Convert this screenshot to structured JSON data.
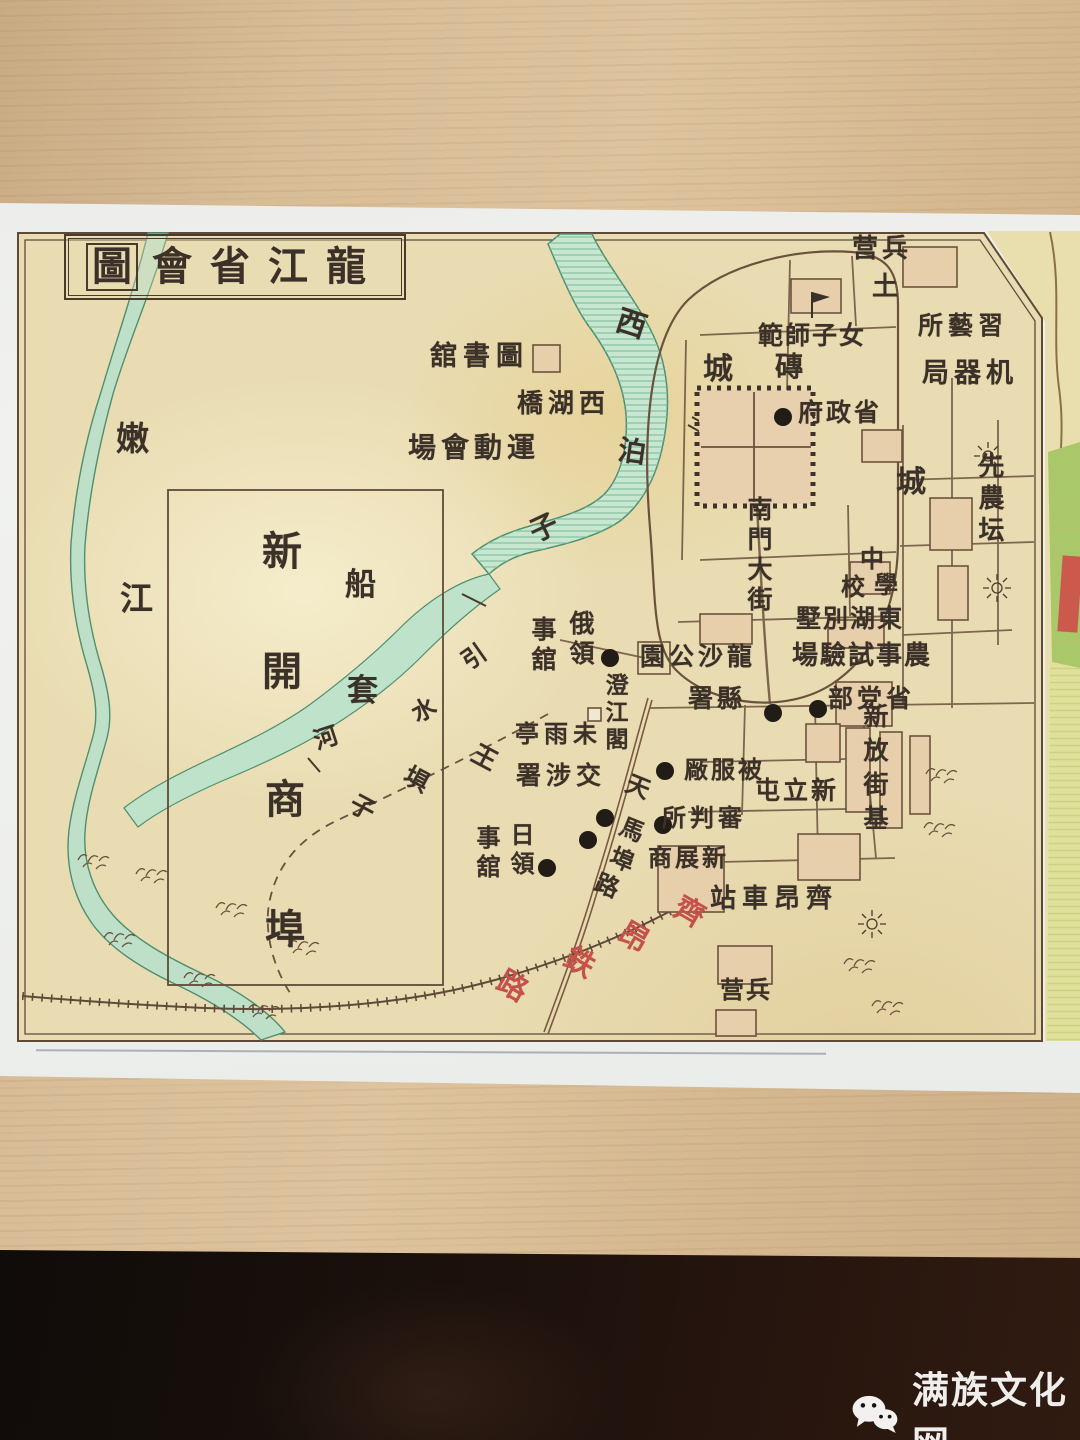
{
  "photo": {
    "scene": "old printed city map lying on a light wood table, dark foreground below table edge",
    "wood_color": "#d8bd97",
    "paper_color": "#eef0ee",
    "shadow_color": "#1a110c"
  },
  "watermark": {
    "text": "满族文化网",
    "icon": "wechat-icon",
    "color": "#efeeec"
  },
  "map": {
    "title": {
      "boxed_char": "圖",
      "rest_chars": "會省江龍",
      "reading_rtl": "龍江省會圖"
    },
    "colors": {
      "map_bg": "#e9dcb2",
      "line": "#5f4a38",
      "water_fill": "#c5e3cd",
      "water_edge": "#4f8f6f",
      "red_text": "#c4524a",
      "building_fill": "#e8cfab",
      "adjacent_strip_yellow": "#e9dfae",
      "adjacent_strip_green": "#a8c86a",
      "adjacent_red_patch": "#cc5a4c"
    },
    "labels": [
      {
        "t": "舘書圖",
        "reading": "圖書舘",
        "x": 430,
        "y": 343,
        "s": 27,
        "ls": 6
      },
      {
        "t": "橋湖西",
        "reading": "西湖橋",
        "x": 517,
        "y": 391,
        "s": 26,
        "ls": 5
      },
      {
        "t": "場會動運",
        "reading": "運動會場",
        "x": 408,
        "y": 434,
        "s": 28,
        "ls": 5
      },
      {
        "t": "嫩",
        "x": 116,
        "y": 422,
        "s": 33
      },
      {
        "t": "江",
        "x": 120,
        "y": 582,
        "s": 33
      },
      {
        "t": "西",
        "x": 616,
        "y": 310,
        "s": 30,
        "rot": 18
      },
      {
        "t": "泊",
        "x": 618,
        "y": 438,
        "s": 28,
        "rot": 8
      },
      {
        "t": "子",
        "x": 530,
        "y": 514,
        "s": 28,
        "rot": -25
      },
      {
        "t": "引",
        "x": 462,
        "y": 645,
        "s": 24,
        "rot": -35
      },
      {
        "t": "水",
        "x": 412,
        "y": 698,
        "s": 24,
        "rot": -28
      },
      {
        "t": "河",
        "x": 314,
        "y": 726,
        "s": 24,
        "rot": -18
      },
      {
        "t": "磚",
        "x": 775,
        "y": 353,
        "s": 28
      },
      {
        "t": "城",
        "x": 703,
        "y": 355,
        "s": 30
      },
      {
        "t": "土",
        "x": 872,
        "y": 274,
        "s": 26
      },
      {
        "t": "城",
        "x": 896,
        "y": 468,
        "s": 30
      },
      {
        "t": "营兵",
        "reading": "兵营",
        "x": 852,
        "y": 236,
        "s": 26,
        "ls": 4
      },
      {
        "t": "範師子女",
        "reading": "女子師範",
        "x": 758,
        "y": 323,
        "s": 25,
        "ls": 2
      },
      {
        "t": "所藝習",
        "reading": "習藝所",
        "x": 918,
        "y": 313,
        "s": 25,
        "ls": 5
      },
      {
        "t": "局器机",
        "reading": "机器局",
        "x": 922,
        "y": 360,
        "s": 27,
        "ls": 5
      },
      {
        "t": "府政省",
        "reading": "省政府",
        "x": 798,
        "y": 400,
        "s": 25,
        "ls": 3
      },
      {
        "t": "先農坛",
        "x": 976,
        "y": 452,
        "s": 26,
        "dir": "v",
        "ls": 6
      },
      {
        "t": "南門大街",
        "x": 746,
        "y": 496,
        "s": 25,
        "dir": "v",
        "ls": 5
      },
      {
        "t": "中",
        "x": 860,
        "y": 547,
        "s": 24
      },
      {
        "t": "學",
        "x": 874,
        "y": 573,
        "s": 24
      },
      {
        "t": "校",
        "x": 841,
        "y": 575,
        "s": 24
      },
      {
        "t": "墅別湖東",
        "reading": "東湖別墅",
        "x": 796,
        "y": 606,
        "s": 25,
        "ls": 2
      },
      {
        "t": "場驗試事農",
        "reading": "農事試驗場",
        "x": 792,
        "y": 643,
        "s": 26,
        "ls": 2
      },
      {
        "t": "部党省",
        "reading": "省党部",
        "x": 828,
        "y": 686,
        "s": 25,
        "ls": 4
      },
      {
        "t": "園公沙龍",
        "reading": "龍沙公園",
        "x": 640,
        "y": 644,
        "s": 25,
        "ls": 4
      },
      {
        "t": "署縣",
        "reading": "縣署",
        "x": 688,
        "y": 686,
        "s": 25,
        "ls": 4
      },
      {
        "t": "澄江閣",
        "x": 602,
        "y": 673,
        "s": 23,
        "dir": "v",
        "ls": 4
      },
      {
        "t": "亭雨未",
        "reading": "未雨亭",
        "x": 515,
        "y": 722,
        "s": 24,
        "ls": 5
      },
      {
        "t": "俄領",
        "x": 568,
        "y": 610,
        "s": 25,
        "dir": "v",
        "ls": 5
      },
      {
        "t": "事舘",
        "x": 530,
        "y": 616,
        "s": 25,
        "dir": "v",
        "ls": 5
      },
      {
        "t": "署涉交",
        "reading": "交涉署",
        "x": 516,
        "y": 763,
        "s": 25,
        "ls": 5
      },
      {
        "t": "厰服被",
        "reading": "被服厰",
        "x": 684,
        "y": 758,
        "s": 24,
        "ls": 3
      },
      {
        "t": "所判審",
        "reading": "審判所",
        "x": 662,
        "y": 806,
        "s": 24,
        "ls": 4
      },
      {
        "t": "商展新",
        "reading": "新展商",
        "x": 648,
        "y": 846,
        "s": 24,
        "ls": 3
      },
      {
        "t": "屯立新",
        "reading": "新立屯",
        "x": 755,
        "y": 778,
        "s": 25,
        "ls": 3
      },
      {
        "t": "新放街基",
        "x": 862,
        "y": 703,
        "s": 25,
        "dir": "v",
        "ls": 9
      },
      {
        "t": "日領",
        "x": 508,
        "y": 822,
        "s": 24,
        "dir": "v",
        "ls": 5
      },
      {
        "t": "事舘",
        "x": 474,
        "y": 825,
        "s": 24,
        "dir": "v",
        "ls": 5
      },
      {
        "t": "站車昂齊",
        "reading": "齊昂車站",
        "x": 710,
        "y": 886,
        "s": 26,
        "ls": 6
      },
      {
        "t": "营兵",
        "reading": "兵营",
        "x": 720,
        "y": 978,
        "s": 24,
        "ls": 2
      },
      {
        "t": "天",
        "x": 626,
        "y": 775,
        "s": 24,
        "rot": 22
      },
      {
        "t": "馬",
        "x": 620,
        "y": 818,
        "s": 24,
        "rot": 22
      },
      {
        "t": "埠",
        "x": 610,
        "y": 848,
        "s": 24,
        "rot": 22
      },
      {
        "t": "路",
        "x": 595,
        "y": 874,
        "s": 24,
        "rot": 22
      },
      {
        "t": "齊",
        "x": 674,
        "y": 898,
        "s": 30,
        "red": true,
        "rot": 30
      },
      {
        "t": "昂",
        "x": 618,
        "y": 923,
        "s": 30,
        "red": true,
        "rot": 30
      },
      {
        "t": "鉄",
        "x": 564,
        "y": 948,
        "s": 30,
        "red": true,
        "rot": 30
      },
      {
        "t": "路",
        "x": 497,
        "y": 972,
        "s": 30,
        "red": true,
        "rot": 30
      },
      {
        "t": "王",
        "x": 472,
        "y": 745,
        "s": 25,
        "rot": 28
      },
      {
        "t": "埧",
        "x": 404,
        "y": 767,
        "s": 25,
        "rot": 28
      },
      {
        "t": "子",
        "x": 350,
        "y": 795,
        "s": 25,
        "rot": 28
      },
      {
        "t": "船",
        "x": 345,
        "y": 570,
        "s": 31
      },
      {
        "t": "套",
        "x": 347,
        "y": 676,
        "s": 31
      },
      {
        "t": "新",
        "x": 262,
        "y": 532,
        "s": 40
      },
      {
        "t": "開",
        "x": 262,
        "y": 652,
        "s": 40
      },
      {
        "t": "商",
        "x": 265,
        "y": 780,
        "s": 40
      },
      {
        "t": "埠",
        "x": 265,
        "y": 910,
        "s": 40
      }
    ]
  }
}
